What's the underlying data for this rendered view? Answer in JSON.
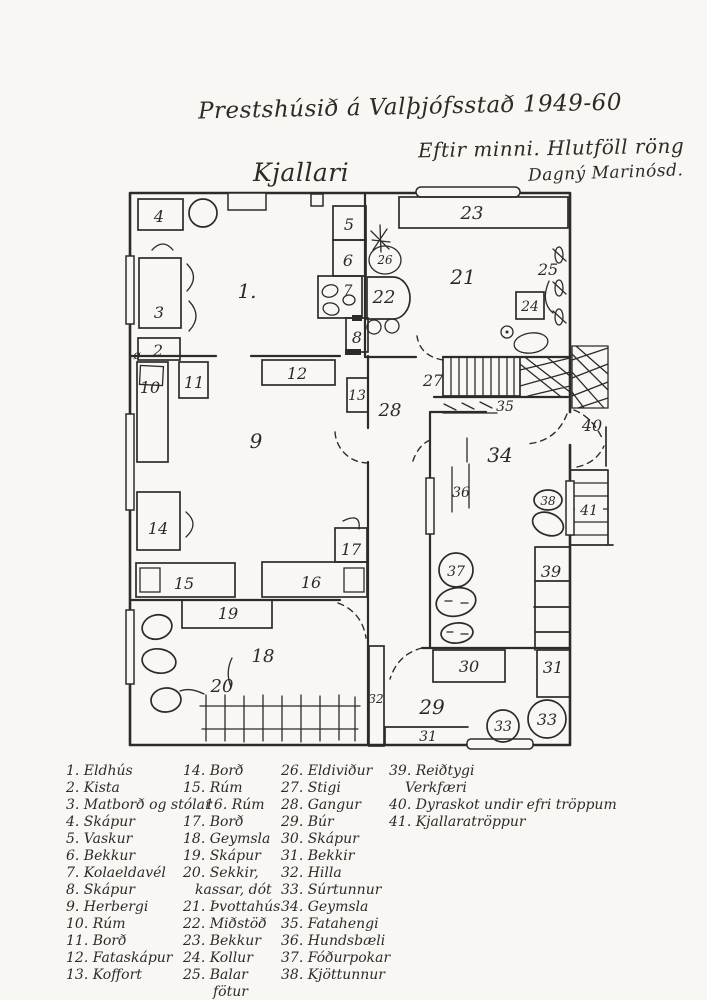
{
  "page": {
    "title": "Prestshúsið á Valþjófsstað 1949-60",
    "subtitle": "Eftir minni.  Hlutföll röng",
    "signature": "Dagný Marinósd.",
    "plan_heading": "Kjallari"
  },
  "plan": {
    "labels": {
      "n1": "1.",
      "n2": "2",
      "n3": "3",
      "n4": "4",
      "n5": "5",
      "n6": "6",
      "n7": "7",
      "n8": "8",
      "n9": "9",
      "n10": "10",
      "n11": "11",
      "n12": "12",
      "n13": "13",
      "n14": "14",
      "n15": "15",
      "n16": "16",
      "n17": "17",
      "n18": "18",
      "n19": "19",
      "n20": "20",
      "n21": "21",
      "n22": "22",
      "n23": "23",
      "n24": "24",
      "n25": "25",
      "n26": "26",
      "n27": "27",
      "n28": "28",
      "n29": "29",
      "n30": "30",
      "n31a": "31",
      "n31b": "31",
      "n32": "32",
      "n33a": "33",
      "n33b": "33",
      "n34": "34",
      "n35": "35",
      "n36": "36",
      "n37": "37",
      "n38": "38",
      "n39": "39",
      "n40": "40",
      "n41": "41",
      "slash_o": "ø"
    }
  },
  "legend": {
    "columns": [
      {
        "items": [
          "1. Eldhús",
          "2. Kista",
          "3. Matborð og stólar",
          "4. Skápur",
          "5. Vaskur",
          "6. Bekkur",
          "7. Kolaeldavél",
          "8. Skápur",
          "9. Herbergi",
          "10. Rúm",
          "11. Borð",
          "12. Fataskápur",
          "13. Koffort"
        ]
      },
      {
        "items": [
          "14. Borð",
          "15. Rúm",
          "16. Rúm",
          "17. Borð",
          "18. Geymsla",
          "19. Skápur",
          "20. Sekkir,",
          "kassar, dót",
          "21. Þvottahús",
          "22. Miðstöð",
          "23. Bekkur",
          "24. Kollur",
          "25. Balar",
          "fötur"
        ]
      },
      {
        "items": [
          "26. Eldiviður",
          "27. Stigi",
          "28. Gangur",
          "29. Búr",
          "30. Skápur",
          "31. Bekkir",
          "32. Hilla",
          "33. Súrtunnur",
          "34. Geymsla",
          "35. Fatahengi",
          "36. Hundsbæli",
          "37. Fóðurpokar",
          "38. Kjöttunnur"
        ]
      },
      {
        "items": [
          "39. Reiðtygi",
          "Verkfæri",
          "40. Dyraskot undir efri tröppum",
          "41. Kjallaratröppur"
        ]
      }
    ]
  },
  "colors": {
    "ink": "#2d2b28",
    "paper": "#f8f7f4"
  }
}
